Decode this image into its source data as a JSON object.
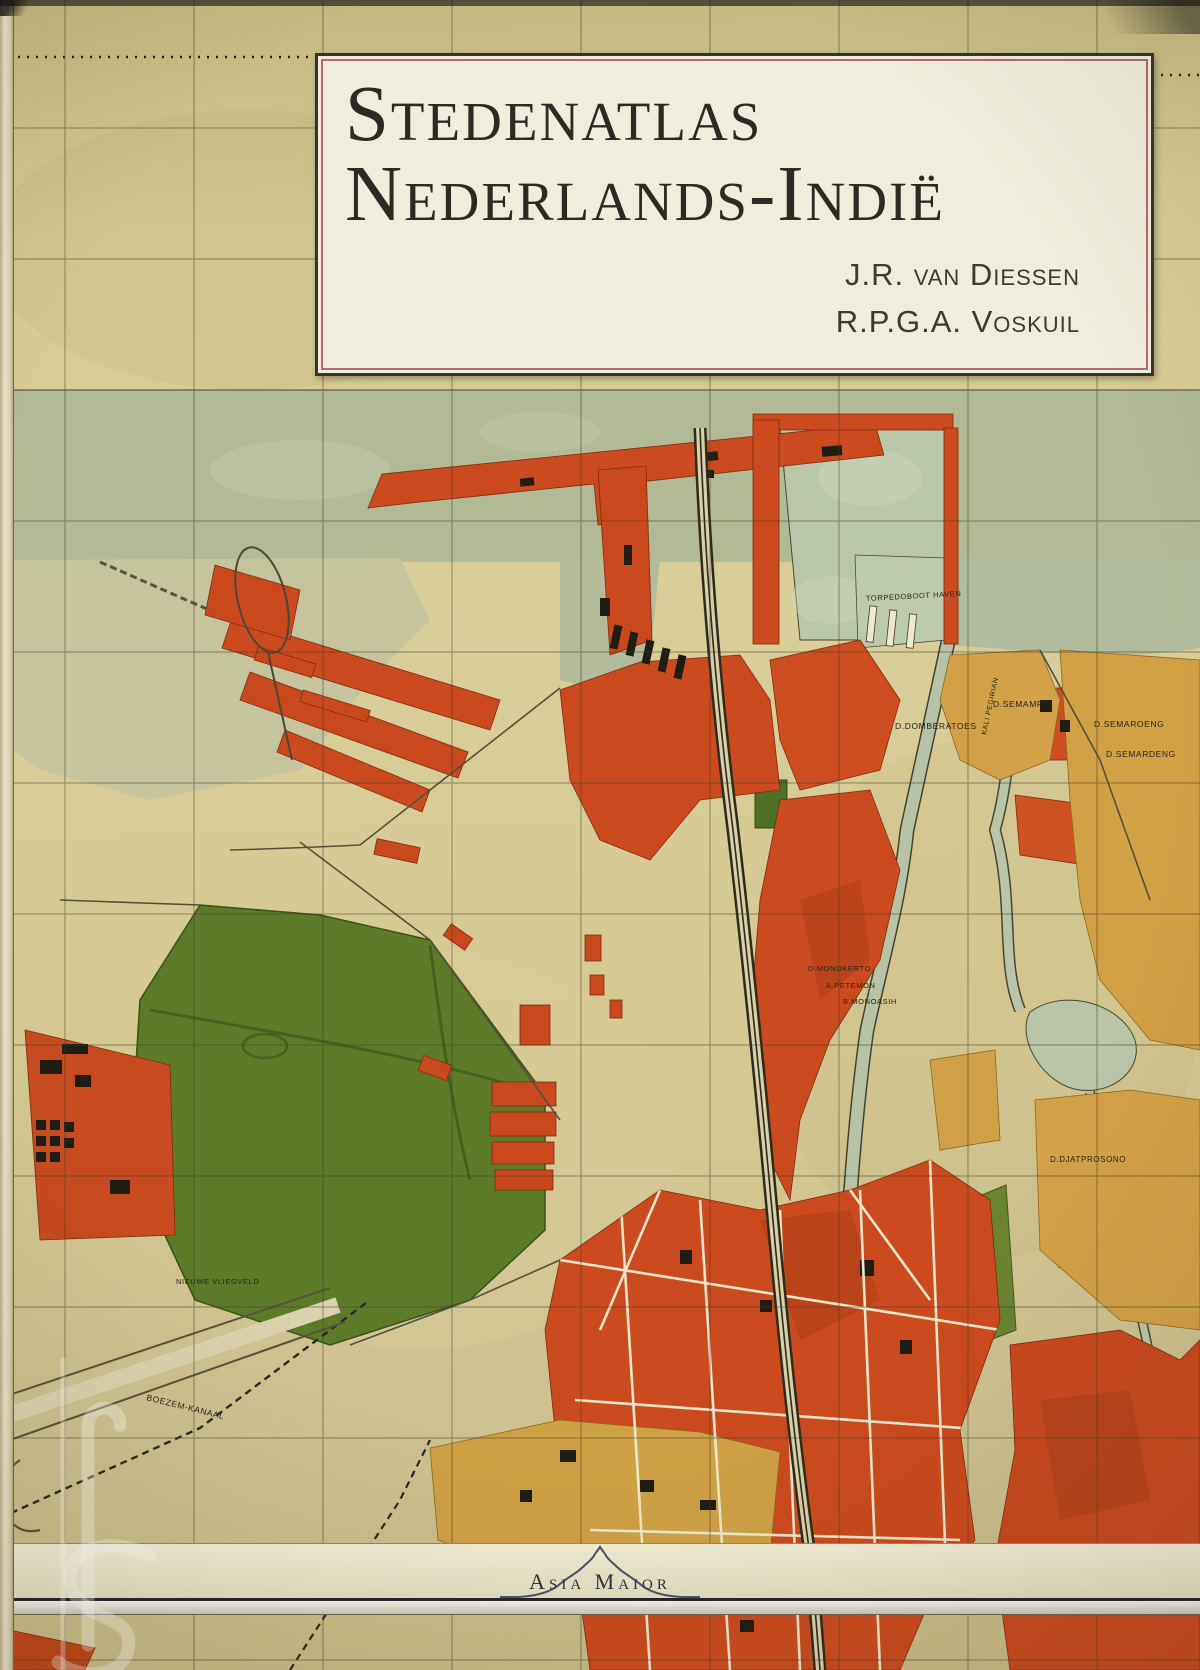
{
  "cover": {
    "title_line1": "Stedenatlas",
    "title_line2": "Nederlands-Indië",
    "author1": "J.R. van Diessen",
    "author2": "R.P.G.A. Voskuil",
    "publisher": "Asia Maior"
  },
  "map_labels": {
    "torpedoboot_haven": "TORPEDOBOOT HAVEN",
    "d_semampir": "D.SEMAMPIR",
    "d_domberatoes": "D.DOMBERATOES",
    "d_semaroeng": "D.SEMAROENG",
    "d_semardeng": "D.SEMARDENG",
    "kali_pegirian": "KALI PEGIRIAN",
    "d_monokerto": "D.MONOKERTO",
    "b_monoasih": "B.MONOASIH",
    "a_petemon": "A.PETEMON",
    "d_djatprosono": "D.DJATPROSONO",
    "nieuwe_vliegveld": "NIEUWE VLIEGVELD",
    "boezem_kanaal": "BOEZEM-KANAAL"
  },
  "colors": {
    "paper": "#d8cc97",
    "sea": "#b4ba97",
    "basin": "#b9c6a8",
    "urban_orange": "#cc4a1f",
    "urban_dark": "#a83c16",
    "district_tan": "#d3a148",
    "field_green": "#5d7a28",
    "ink": "#2e2b1d",
    "title_border_pink": "#b06a74",
    "band_ink_blue": "#4b5268"
  }
}
